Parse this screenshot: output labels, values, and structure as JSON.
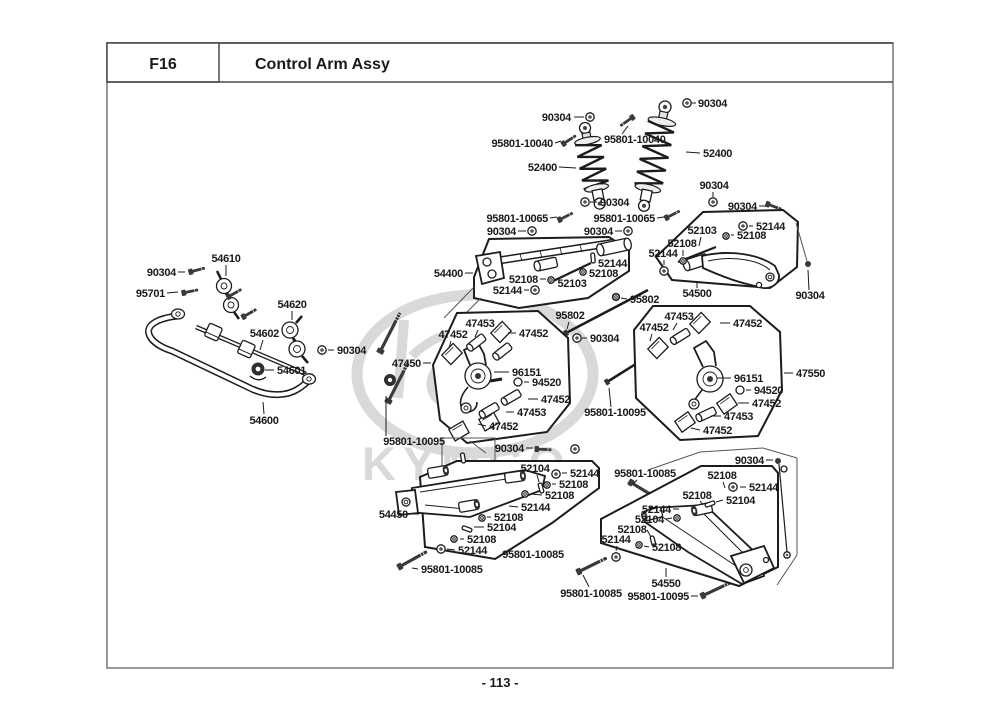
{
  "header": {
    "code": "F16",
    "title": "Control Arm Assy"
  },
  "footer": {
    "page_number": "- 113 -"
  },
  "watermark": {
    "brand": "KYMCO"
  },
  "diagram": {
    "labels": [
      {
        "text": "90304",
        "x": 571,
        "y": 121,
        "anchor": "end",
        "leader": [
          574,
          117,
          584,
          117
        ],
        "fastener": {
          "type": "nut",
          "x": 590,
          "y": 117
        }
      },
      {
        "text": "95801-10040",
        "x": 553,
        "y": 147,
        "anchor": "end",
        "leader": [
          555,
          143,
          561,
          141
        ]
      },
      {
        "text": "95801-10040",
        "x": 604,
        "y": 143,
        "anchor": "start",
        "leader": [
          622,
          134,
          628,
          126
        ]
      },
      {
        "text": "52400",
        "x": 557,
        "y": 171,
        "anchor": "end",
        "leader": [
          559,
          167,
          576,
          168
        ]
      },
      {
        "text": "90304",
        "x": 698,
        "y": 107,
        "anchor": "start",
        "leader": [
          696,
          103,
          692,
          103
        ],
        "fastener": {
          "type": "nut",
          "x": 687,
          "y": 103
        }
      },
      {
        "text": "52400",
        "x": 703,
        "y": 157,
        "anchor": "start",
        "leader": [
          700,
          153,
          686,
          152
        ]
      },
      {
        "text": "90304",
        "x": 714,
        "y": 189,
        "anchor": "middle",
        "leader": [
          713,
          192,
          713,
          197
        ],
        "fastener": {
          "type": "nut",
          "x": 713,
          "y": 202
        }
      },
      {
        "text": "90304",
        "x": 600,
        "y": 206,
        "anchor": "start",
        "leader": [
          597,
          202,
          590,
          202
        ],
        "fastener": {
          "type": "nut",
          "x": 585,
          "y": 202
        }
      },
      {
        "text": "95801-10065",
        "x": 548,
        "y": 222,
        "anchor": "end",
        "leader": [
          550,
          218,
          557,
          217
        ]
      },
      {
        "text": "95801-10065",
        "x": 655,
        "y": 222,
        "anchor": "end",
        "leader": [
          657,
          218,
          664,
          217
        ]
      },
      {
        "text": "90304",
        "x": 757,
        "y": 210,
        "anchor": "end",
        "leader": [
          759,
          206,
          766,
          206
        ]
      },
      {
        "text": "52144",
        "x": 756,
        "y": 230,
        "anchor": "start",
        "leader": [
          753,
          226,
          749,
          226
        ],
        "fastener": {
          "type": "nut",
          "x": 743,
          "y": 226
        }
      },
      {
        "text": "52103",
        "x": 702,
        "y": 234,
        "anchor": "middle",
        "leader": [
          701,
          237,
          699,
          246
        ]
      },
      {
        "text": "52108",
        "x": 737,
        "y": 239,
        "anchor": "start",
        "leader": [
          734,
          235,
          731,
          235
        ],
        "fastener": {
          "type": "washer",
          "x": 726,
          "y": 236
        }
      },
      {
        "text": "52108",
        "x": 682,
        "y": 247,
        "anchor": "middle",
        "leader": [
          683,
          250,
          683,
          256
        ],
        "fastener": {
          "type": "washer",
          "x": 683,
          "y": 261
        }
      },
      {
        "text": "52144",
        "x": 663,
        "y": 257,
        "anchor": "middle",
        "leader": [
          664,
          260,
          664,
          265
        ],
        "fastener": {
          "type": "nut",
          "x": 664,
          "y": 271
        }
      },
      {
        "text": "54500",
        "x": 697,
        "y": 297,
        "anchor": "middle",
        "leader": [
          697,
          288,
          697,
          281
        ]
      },
      {
        "text": "90304",
        "x": 810,
        "y": 299,
        "anchor": "middle",
        "leader": [
          809,
          290,
          808,
          270
        ]
      },
      {
        "text": "90304",
        "x": 516,
        "y": 235,
        "anchor": "end",
        "leader": [
          518,
          231,
          526,
          231
        ],
        "fastener": {
          "type": "nut",
          "x": 532,
          "y": 231
        }
      },
      {
        "text": "90304",
        "x": 613,
        "y": 235,
        "anchor": "end",
        "leader": [
          615,
          231,
          622,
          231
        ],
        "fastener": {
          "type": "nut",
          "x": 628,
          "y": 231
        }
      },
      {
        "text": "54400",
        "x": 463,
        "y": 277,
        "anchor": "end",
        "leader": [
          465,
          273,
          473,
          273
        ]
      },
      {
        "text": "52144",
        "x": 598,
        "y": 267,
        "anchor": "start",
        "fastener": {
          "type": "pin",
          "x": 593,
          "y": 258,
          "angle": 85
        }
      },
      {
        "text": "52108",
        "x": 589,
        "y": 277,
        "anchor": "start",
        "fastener": {
          "type": "washer",
          "x": 583,
          "y": 272
        }
      },
      {
        "text": "52108",
        "x": 538,
        "y": 283,
        "anchor": "end",
        "leader": [
          540,
          279,
          546,
          279
        ],
        "fastener": {
          "type": "washer",
          "x": 551,
          "y": 280
        }
      },
      {
        "text": "52103",
        "x": 572,
        "y": 287,
        "anchor": "middle"
      },
      {
        "text": "52144",
        "x": 522,
        "y": 294,
        "anchor": "end",
        "leader": [
          524,
          290,
          529,
          290
        ],
        "fastener": {
          "type": "nut",
          "x": 535,
          "y": 290
        }
      },
      {
        "text": "95802",
        "x": 630,
        "y": 303,
        "anchor": "start",
        "leader": [
          627,
          299,
          621,
          298
        ],
        "fastener": {
          "type": "washer",
          "x": 616,
          "y": 297
        }
      },
      {
        "text": "95802",
        "x": 570,
        "y": 319,
        "anchor": "middle",
        "leader": [
          569,
          322,
          567,
          329
        ]
      },
      {
        "text": "90304",
        "x": 590,
        "y": 342,
        "anchor": "start",
        "leader": [
          587,
          338,
          582,
          338
        ],
        "fastener": {
          "type": "nut",
          "x": 577,
          "y": 338
        }
      },
      {
        "text": "47453",
        "x": 480,
        "y": 327,
        "anchor": "middle",
        "leader": [
          478,
          330,
          475,
          337
        ]
      },
      {
        "text": "47452",
        "x": 453,
        "y": 338,
        "anchor": "middle",
        "leader": [
          451,
          341,
          449,
          348
        ]
      },
      {
        "text": "47452",
        "x": 519,
        "y": 337,
        "anchor": "start",
        "leader": [
          516,
          333,
          508,
          333
        ]
      },
      {
        "text": "47450",
        "x": 421,
        "y": 367,
        "anchor": "end",
        "leader": [
          423,
          363,
          431,
          363
        ]
      },
      {
        "text": "96151",
        "x": 512,
        "y": 376,
        "anchor": "start",
        "leader": [
          509,
          372,
          494,
          372
        ]
      },
      {
        "text": "94520",
        "x": 532,
        "y": 386,
        "anchor": "start",
        "leader": [
          529,
          382,
          524,
          382
        ],
        "fastener": {
          "type": "circle",
          "x": 518,
          "y": 382
        }
      },
      {
        "text": "47452",
        "x": 541,
        "y": 403,
        "anchor": "start",
        "leader": [
          538,
          399,
          528,
          399
        ]
      },
      {
        "text": "47453",
        "x": 517,
        "y": 416,
        "anchor": "start",
        "leader": [
          514,
          412,
          506,
          412
        ]
      },
      {
        "text": "47452",
        "x": 489,
        "y": 430,
        "anchor": "start",
        "leader": [
          486,
          426,
          478,
          424
        ]
      },
      {
        "text": "95801-10095",
        "x": 414,
        "y": 445,
        "anchor": "middle",
        "leader": [
          386,
          436,
          386,
          396
        ]
      },
      {
        "text": "90304",
        "x": 524,
        "y": 452,
        "anchor": "end",
        "leader": [
          526,
          448,
          533,
          448
        ],
        "fastener": {
          "type": "nut",
          "x": 575,
          "y": 449
        }
      },
      {
        "text": "47453",
        "x": 679,
        "y": 320,
        "anchor": "middle",
        "leader": [
          677,
          323,
          673,
          330
        ]
      },
      {
        "text": "47452",
        "x": 654,
        "y": 331,
        "anchor": "middle",
        "leader": [
          652,
          334,
          650,
          341
        ]
      },
      {
        "text": "47452",
        "x": 733,
        "y": 327,
        "anchor": "start",
        "leader": [
          730,
          323,
          720,
          323
        ]
      },
      {
        "text": "96151",
        "x": 734,
        "y": 382,
        "anchor": "start",
        "leader": [
          731,
          378,
          717,
          378
        ]
      },
      {
        "text": "94520",
        "x": 754,
        "y": 394,
        "anchor": "start",
        "leader": [
          751,
          390,
          746,
          390
        ],
        "fastener": {
          "type": "circle",
          "x": 740,
          "y": 390
        }
      },
      {
        "text": "47452",
        "x": 752,
        "y": 407,
        "anchor": "start",
        "leader": [
          749,
          403,
          738,
          403
        ]
      },
      {
        "text": "47453",
        "x": 724,
        "y": 420,
        "anchor": "start",
        "leader": [
          721,
          416,
          711,
          416
        ]
      },
      {
        "text": "47452",
        "x": 703,
        "y": 434,
        "anchor": "start",
        "leader": [
          700,
          430,
          691,
          428
        ]
      },
      {
        "text": "47550",
        "x": 796,
        "y": 377,
        "anchor": "start",
        "leader": [
          793,
          373,
          784,
          373
        ]
      },
      {
        "text": "95801-10095",
        "x": 615,
        "y": 416,
        "anchor": "middle",
        "leader": [
          611,
          407,
          609,
          388
        ]
      },
      {
        "text": "52104",
        "x": 535,
        "y": 472,
        "anchor": "middle",
        "leader": [
          537,
          475,
          539,
          482
        ],
        "fastener": {
          "type": "pin",
          "x": 541,
          "y": 488,
          "angle": 75
        }
      },
      {
        "text": "52144",
        "x": 570,
        "y": 477,
        "anchor": "start",
        "leader": [
          567,
          473,
          562,
          473
        ],
        "fastener": {
          "type": "nut",
          "x": 556,
          "y": 474
        }
      },
      {
        "text": "52108",
        "x": 559,
        "y": 488,
        "anchor": "start",
        "leader": [
          556,
          484,
          552,
          484
        ],
        "fastener": {
          "type": "washer",
          "x": 547,
          "y": 485
        }
      },
      {
        "text": "52108",
        "x": 545,
        "y": 499,
        "anchor": "start",
        "leader": [
          542,
          495,
          531,
          494
        ],
        "fastener": {
          "type": "washer",
          "x": 525,
          "y": 494
        }
      },
      {
        "text": "52144",
        "x": 521,
        "y": 511,
        "anchor": "start",
        "leader": [
          518,
          507,
          509,
          506
        ]
      },
      {
        "text": "52108",
        "x": 494,
        "y": 521,
        "anchor": "start",
        "leader": [
          491,
          517,
          487,
          517
        ],
        "fastener": {
          "type": "washer",
          "x": 482,
          "y": 518
        }
      },
      {
        "text": "52104",
        "x": 487,
        "y": 531,
        "anchor": "start",
        "leader": [
          484,
          527,
          474,
          527
        ],
        "fastener": {
          "type": "pin",
          "x": 467,
          "y": 529,
          "angle": 20
        }
      },
      {
        "text": "52108",
        "x": 467,
        "y": 543,
        "anchor": "start",
        "leader": [
          464,
          539,
          460,
          539
        ],
        "fastener": {
          "type": "washer",
          "x": 454,
          "y": 539
        }
      },
      {
        "text": "52144",
        "x": 458,
        "y": 554,
        "anchor": "start",
        "leader": [
          455,
          550,
          447,
          549
        ],
        "fastener": {
          "type": "nut",
          "x": 441,
          "y": 549
        }
      },
      {
        "text": "54450",
        "x": 408,
        "y": 518,
        "anchor": "end",
        "leader": [
          410,
          514,
          419,
          514
        ]
      },
      {
        "text": "95801-10085",
        "x": 533,
        "y": 558,
        "anchor": "middle"
      },
      {
        "text": "95801-10085",
        "x": 421,
        "y": 573,
        "anchor": "start",
        "leader": [
          418,
          569,
          412,
          568
        ]
      },
      {
        "text": "90304",
        "x": 764,
        "y": 464,
        "anchor": "end",
        "leader": [
          766,
          460,
          773,
          460
        ]
      },
      {
        "text": "95801-10085",
        "x": 645,
        "y": 477,
        "anchor": "middle",
        "leader": [
          637,
          480,
          633,
          484
        ]
      },
      {
        "text": "52108",
        "x": 722,
        "y": 479,
        "anchor": "middle",
        "leader": [
          723,
          482,
          725,
          488
        ]
      },
      {
        "text": "52144",
        "x": 749,
        "y": 491,
        "anchor": "start",
        "leader": [
          746,
          487,
          740,
          487
        ],
        "fastener": {
          "type": "nut",
          "x": 733,
          "y": 487
        }
      },
      {
        "text": "52108",
        "x": 697,
        "y": 499,
        "anchor": "middle",
        "leader": [
          700,
          501,
          703,
          505
        ]
      },
      {
        "text": "52104",
        "x": 726,
        "y": 504,
        "anchor": "start",
        "leader": [
          723,
          500,
          716,
          502
        ],
        "fastener": {
          "type": "pin",
          "x": 710,
          "y": 504,
          "angle": -20
        }
      },
      {
        "text": "52144",
        "x": 671,
        "y": 513,
        "anchor": "end",
        "leader": [
          673,
          509,
          679,
          509
        ]
      },
      {
        "text": "52104",
        "x": 664,
        "y": 523,
        "anchor": "end",
        "leader": [
          666,
          519,
          672,
          518
        ],
        "fastener": {
          "type": "washer",
          "x": 677,
          "y": 518
        }
      },
      {
        "text": "52108",
        "x": 632,
        "y": 533,
        "anchor": "middle",
        "leader": [
          647,
          530,
          651,
          537
        ],
        "fastener": {
          "type": "pin",
          "x": 653,
          "y": 541,
          "angle": 75
        }
      },
      {
        "text": "52144",
        "x": 616,
        "y": 543,
        "anchor": "middle",
        "leader": [
          617,
          546,
          616,
          551
        ],
        "fastener": {
          "type": "nut",
          "x": 616,
          "y": 557
        }
      },
      {
        "text": "52108",
        "x": 652,
        "y": 551,
        "anchor": "start",
        "leader": [
          649,
          547,
          644,
          546
        ],
        "fastener": {
          "type": "washer",
          "x": 639,
          "y": 545
        }
      },
      {
        "text": "54550",
        "x": 666,
        "y": 587,
        "anchor": "middle",
        "leader": [
          666,
          577,
          666,
          568
        ]
      },
      {
        "text": "95801-10095",
        "x": 689,
        "y": 600,
        "anchor": "end",
        "leader": [
          691,
          596,
          698,
          596
        ]
      },
      {
        "text": "95801-10085",
        "x": 591,
        "y": 597,
        "anchor": "middle",
        "leader": [
          589,
          587,
          583,
          575
        ]
      },
      {
        "text": "54610",
        "x": 226,
        "y": 262,
        "anchor": "middle",
        "leader": [
          226,
          265,
          226,
          276
        ]
      },
      {
        "text": "90304",
        "x": 176,
        "y": 276,
        "anchor": "end",
        "leader": [
          178,
          272,
          185,
          272
        ]
      },
      {
        "text": "95701",
        "x": 165,
        "y": 297,
        "anchor": "end",
        "leader": [
          167,
          293,
          178,
          292
        ]
      },
      {
        "text": "54620",
        "x": 292,
        "y": 308,
        "anchor": "middle",
        "leader": [
          292,
          311,
          292,
          320
        ]
      },
      {
        "text": "54602",
        "x": 279,
        "y": 337,
        "anchor": "end",
        "leader": [
          263,
          340,
          260,
          350
        ]
      },
      {
        "text": "90304",
        "x": 337,
        "y": 354,
        "anchor": "start",
        "leader": [
          334,
          350,
          328,
          350
        ],
        "fastener": {
          "type": "nut",
          "x": 322,
          "y": 350
        }
      },
      {
        "text": "54601",
        "x": 277,
        "y": 374,
        "anchor": "start",
        "leader": [
          274,
          370,
          265,
          370
        ]
      },
      {
        "text": "54600",
        "x": 264,
        "y": 424,
        "anchor": "middle",
        "leader": [
          264,
          414,
          263,
          402
        ]
      }
    ]
  }
}
